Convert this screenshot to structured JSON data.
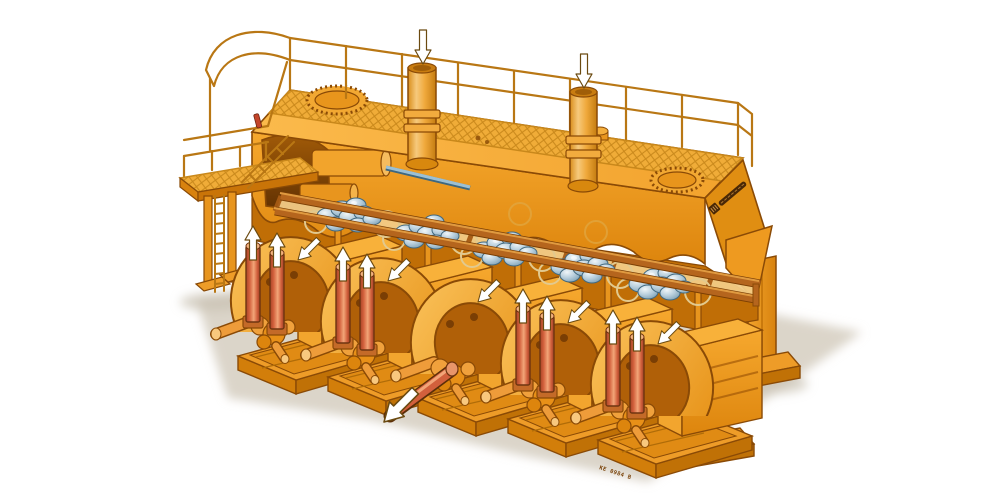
{
  "figure": {
    "alt": "Isometric cutaway illustration of a long orange industrial machine: overhead walkway with guard railings, two vertical cylinders with downward arrows, left access platform with ladder, an inclined rack carrying bundles of blue-grey billets, and five drive units below with red cylinders, upward arrows and an extracted output shaft with a down-left arrow",
    "base_stamp": "KE 0984 B",
    "drive_unit_count": 5,
    "billet_cluster_count": 5,
    "chimney_count": 2,
    "manhole_count": 2,
    "arrow_directions": {
      "chimneys": "down",
      "unit_cylinders": "up",
      "unit_guards": "down-left",
      "output_shaft": "down-left"
    }
  },
  "palette": {
    "background": "#FFFFFF",
    "body": "#F5A228",
    "bodyLight": "#FBC35C",
    "bodyDark": "#DD850D",
    "bodyDeep": "#C06E06",
    "outline": "#8A4A06",
    "mesh": "#C9881B",
    "railing": "#B97714",
    "panel": "#F2CB86",
    "rail": "#B5651D",
    "billet": "#9BBCCE",
    "billetOutline": "#41687E",
    "redCylinder": "#D2603C",
    "arrowFill": "#FFFFFF",
    "arrowOutline": "#6B4A10",
    "shadow": "#D5CEC0",
    "stampColor": "#7A4208",
    "accentRed": "#C4452A",
    "steelBlue": "#9CC0D4"
  }
}
